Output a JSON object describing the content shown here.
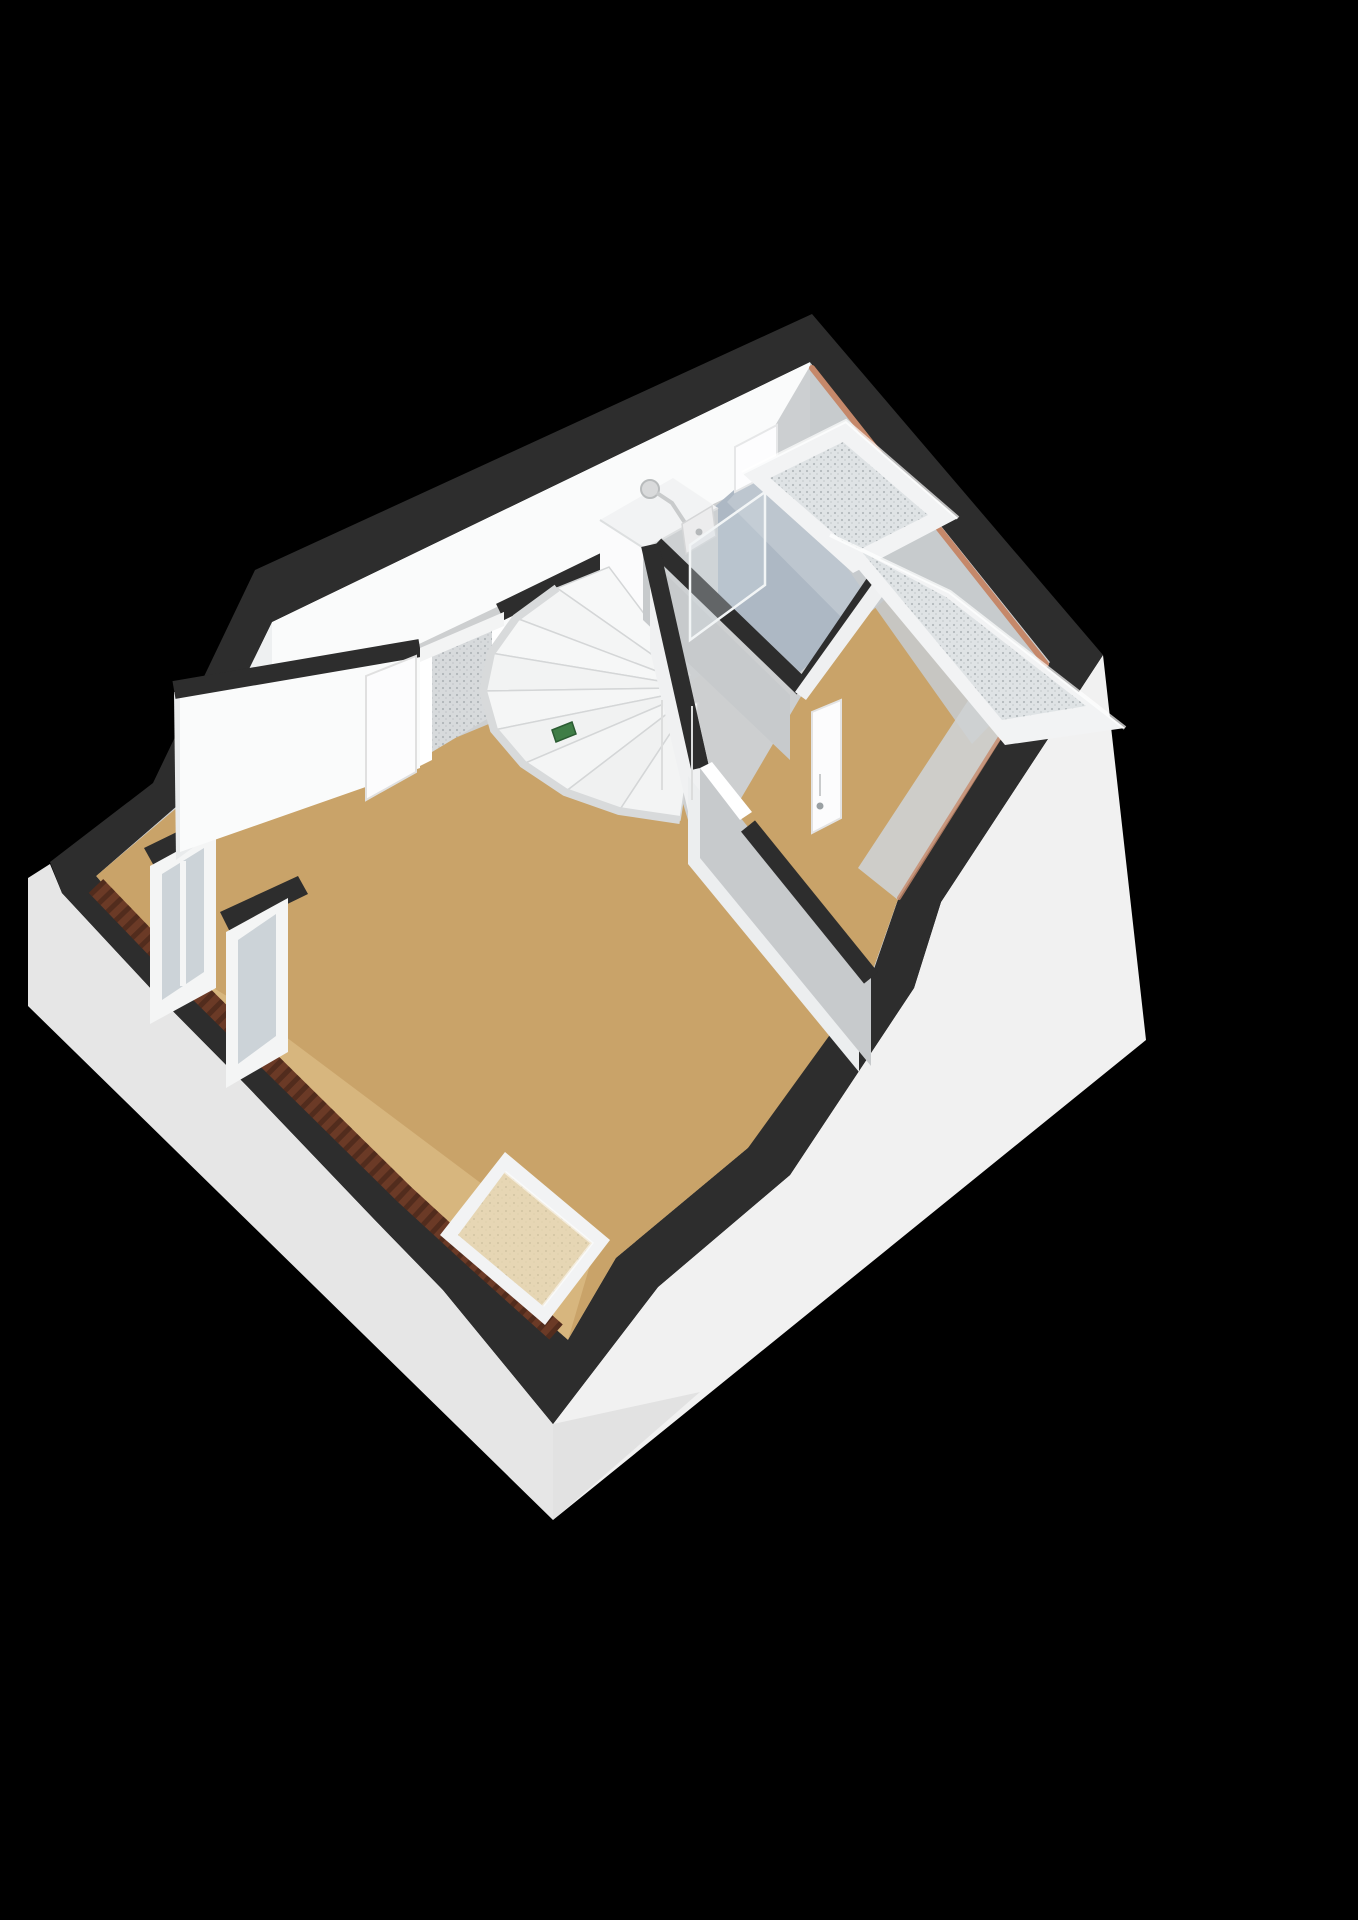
{
  "scene": {
    "kind": "3d-floorplan-render",
    "floor_shown": "attic-floor",
    "background": "#000000"
  },
  "colors": {
    "background": "#000000",
    "wall_cap_dark": "#2d2d2d",
    "wall_light": "#fafbfb",
    "wall_mid": "#e9ebec",
    "wall_shaded": "#c7cacc",
    "exterior_light": "#f1f1f1",
    "exterior_shaded": "#e6e6e6",
    "floor_wood": "#c9a369",
    "floor_wood_slope": "#d8b77f",
    "floor_hall": "#cdcfd0",
    "floor_bathroom": "#adb8c4",
    "roof_trim_salmon": "#c5886a",
    "brick": "#6b3a26",
    "brick_dark": "#47261a",
    "skylight_frame": "#f2f3f4",
    "skylight_glass": "#dfe3e5",
    "skylight_floor_glass": "#e6d6b4",
    "window_glass": "#ccd3d8",
    "stair_tread": "#f5f6f6",
    "stair_side": "#d8dadb",
    "core_face_light": "#fbfbfc",
    "core_face_shaded": "#cdd0d2",
    "door_leaf": "#fcfcfd",
    "door_hardware": "#9aa0a3",
    "glass_screen": "#d3dde3",
    "plant_green": "#3f7d46",
    "shower_metal": "#c9cbcc"
  }
}
